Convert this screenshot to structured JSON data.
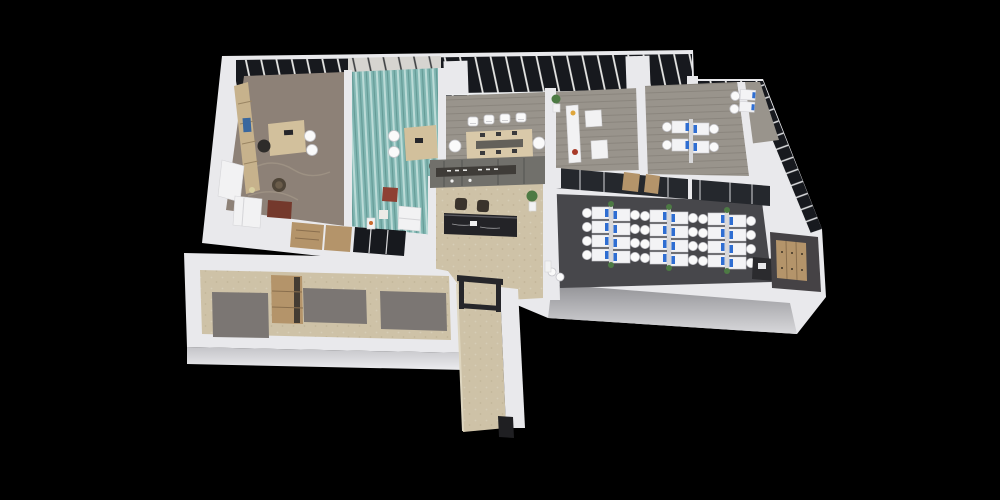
{
  "scene": {
    "title": "3D isometric render of an office floor plan on a black background",
    "canvas": {
      "width": 1000,
      "height": 500
    },
    "background": "#000000"
  },
  "palette": {
    "bg": "#000000",
    "wall": "#e9e9ec",
    "wallFaceTop": "#929296",
    "wallFaceBottom": "#d8d8db",
    "glaze": "#17191e",
    "mullion": "#e9e9e7",
    "blind": "#d6d4d0",
    "blindLine": "#3b3d40",
    "woodFloor": "#8d8177",
    "woodStreak": "#a89c8c",
    "teal": "#82b7b3",
    "tealLight": "#c9e4e0",
    "tealDark": "#5e948f",
    "plank": "#99948c",
    "beige": "#cec2a7",
    "carpet": "#47474b",
    "tile": "#7b7673",
    "wood": "#b4946a",
    "woodDark": "#8a6f4e",
    "desk": "#f3f3f5",
    "deskEdge": "#cfcfd4",
    "chairWhite": "#fafafa",
    "chairEdge": "#c6c6cb",
    "monitor": "#2f6ed2",
    "counter": "#232327",
    "feature": "#71706b",
    "featureStrip": "#3f3c38",
    "red": "#8e4033",
    "green": "#4d7a44",
    "frameDark": "#26262a",
    "darkChair": "#3a332c",
    "shelfWood": "#c7b28c",
    "deskWood": "#d2c09c"
  },
  "rooms": [
    {
      "id": "executive-office",
      "label": "Executive office",
      "floor": "wood",
      "furniture": [
        "shelving wall",
        "L desk",
        "2 guest chairs",
        "executive chair",
        "white sofa",
        "red coffee table",
        "round lounge chair"
      ]
    },
    {
      "id": "teal-carpet-office",
      "label": "Manager office (teal carpet)",
      "floor": "teal carpet",
      "furniture": [
        "desk",
        "2 guest chairs",
        "red armchair",
        "white sofa",
        "side table"
      ]
    },
    {
      "id": "meeting-room",
      "label": "Meeting room",
      "floor": "grey plank",
      "furniture": [
        "conference table",
        "6 chairs"
      ]
    },
    {
      "id": "lounge",
      "label": "Lounge room",
      "floor": "grey plank",
      "furniture": [
        "bookcase",
        "armchair",
        "low table",
        "plant"
      ]
    },
    {
      "id": "team-office",
      "label": "Team office",
      "floor": "grey plank",
      "furniture": [
        "4-desk cluster with monitors"
      ]
    },
    {
      "id": "corner-office",
      "label": "Corner office",
      "floor": "grey plank",
      "furniture": [
        "2 desks with monitors"
      ]
    },
    {
      "id": "reception",
      "label": "Reception lobby",
      "floor": "beige stone",
      "furniture": [
        "dark marble counter",
        "2 dark chairs",
        "feature wall",
        "plant"
      ]
    },
    {
      "id": "open-plan-office",
      "label": "Open-plan office",
      "floor": "dark carpet",
      "furniture": [
        "3 workstation clusters",
        "printer station"
      ]
    },
    {
      "id": "pantry",
      "label": "Pantry / storage nook",
      "floor": "dark",
      "furniture": [
        "wood cabinet"
      ]
    },
    {
      "id": "service-wing",
      "label": "Service wing (restrooms / storage)",
      "floor": "beige + grey tile",
      "furniture": [
        "wood cabinet"
      ]
    },
    {
      "id": "entry-corridor",
      "label": "Entry corridor",
      "floor": "beige stone",
      "furniture": [
        "dark gate frame"
      ]
    }
  ],
  "open_office": {
    "cluster_count": 3,
    "desks_per_cluster": 8,
    "total_desks": 24,
    "monitor_color": "#2f6ed2",
    "cluster_positions": [
      [
        584,
        204
      ],
      [
        642,
        207
      ],
      [
        700,
        210
      ]
    ]
  }
}
